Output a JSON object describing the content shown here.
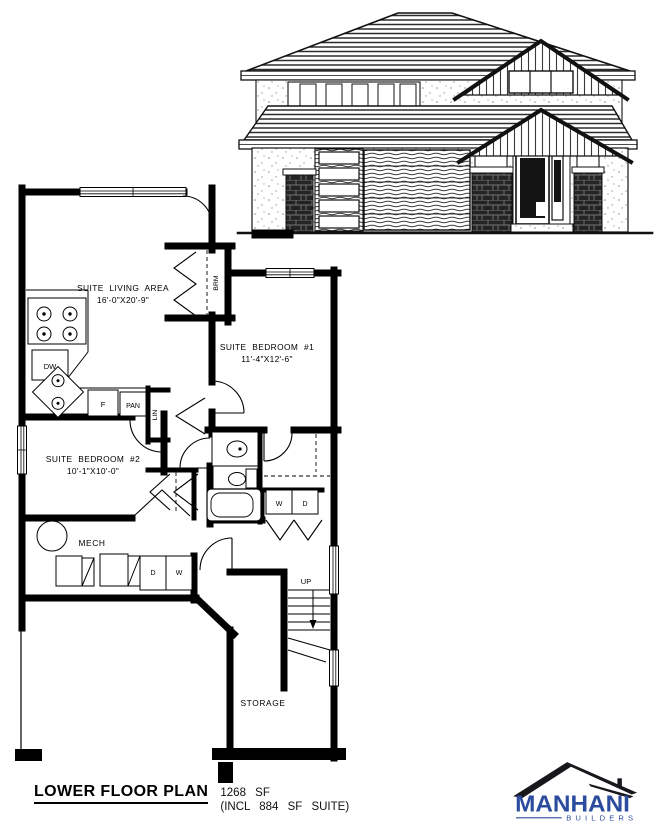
{
  "title_block": {
    "title": "LOWER FLOOR PLAN",
    "area": "1268 SF",
    "suite_note": "(INCL 884 SF SUITE)"
  },
  "logo": {
    "name": "MANHANI",
    "tagline": "BUILDERS",
    "brand_color": "#2b4c9e",
    "roof_color": "#17171c"
  },
  "plan": {
    "rooms": [
      {
        "id": "living",
        "label": "SUITE LIVING AREA",
        "dims": "16'-0\"X20'-9\""
      },
      {
        "id": "bedroom1",
        "label": "SUITE BEDROOM #1",
        "dims": "11'-4\"X12'-6\""
      },
      {
        "id": "bedroom2",
        "label": "SUITE BEDROOM #2",
        "dims": "10'-1\"X10'-0\""
      },
      {
        "id": "mech",
        "label": "MECH"
      },
      {
        "id": "storage",
        "label": "STORAGE"
      }
    ],
    "labels": {
      "dishwasher": "DW",
      "fridge": "F",
      "pantry": "PAN",
      "linen": "LIN",
      "broom": "BRM",
      "washer": "W",
      "dryer": "D",
      "up": "UP"
    }
  }
}
